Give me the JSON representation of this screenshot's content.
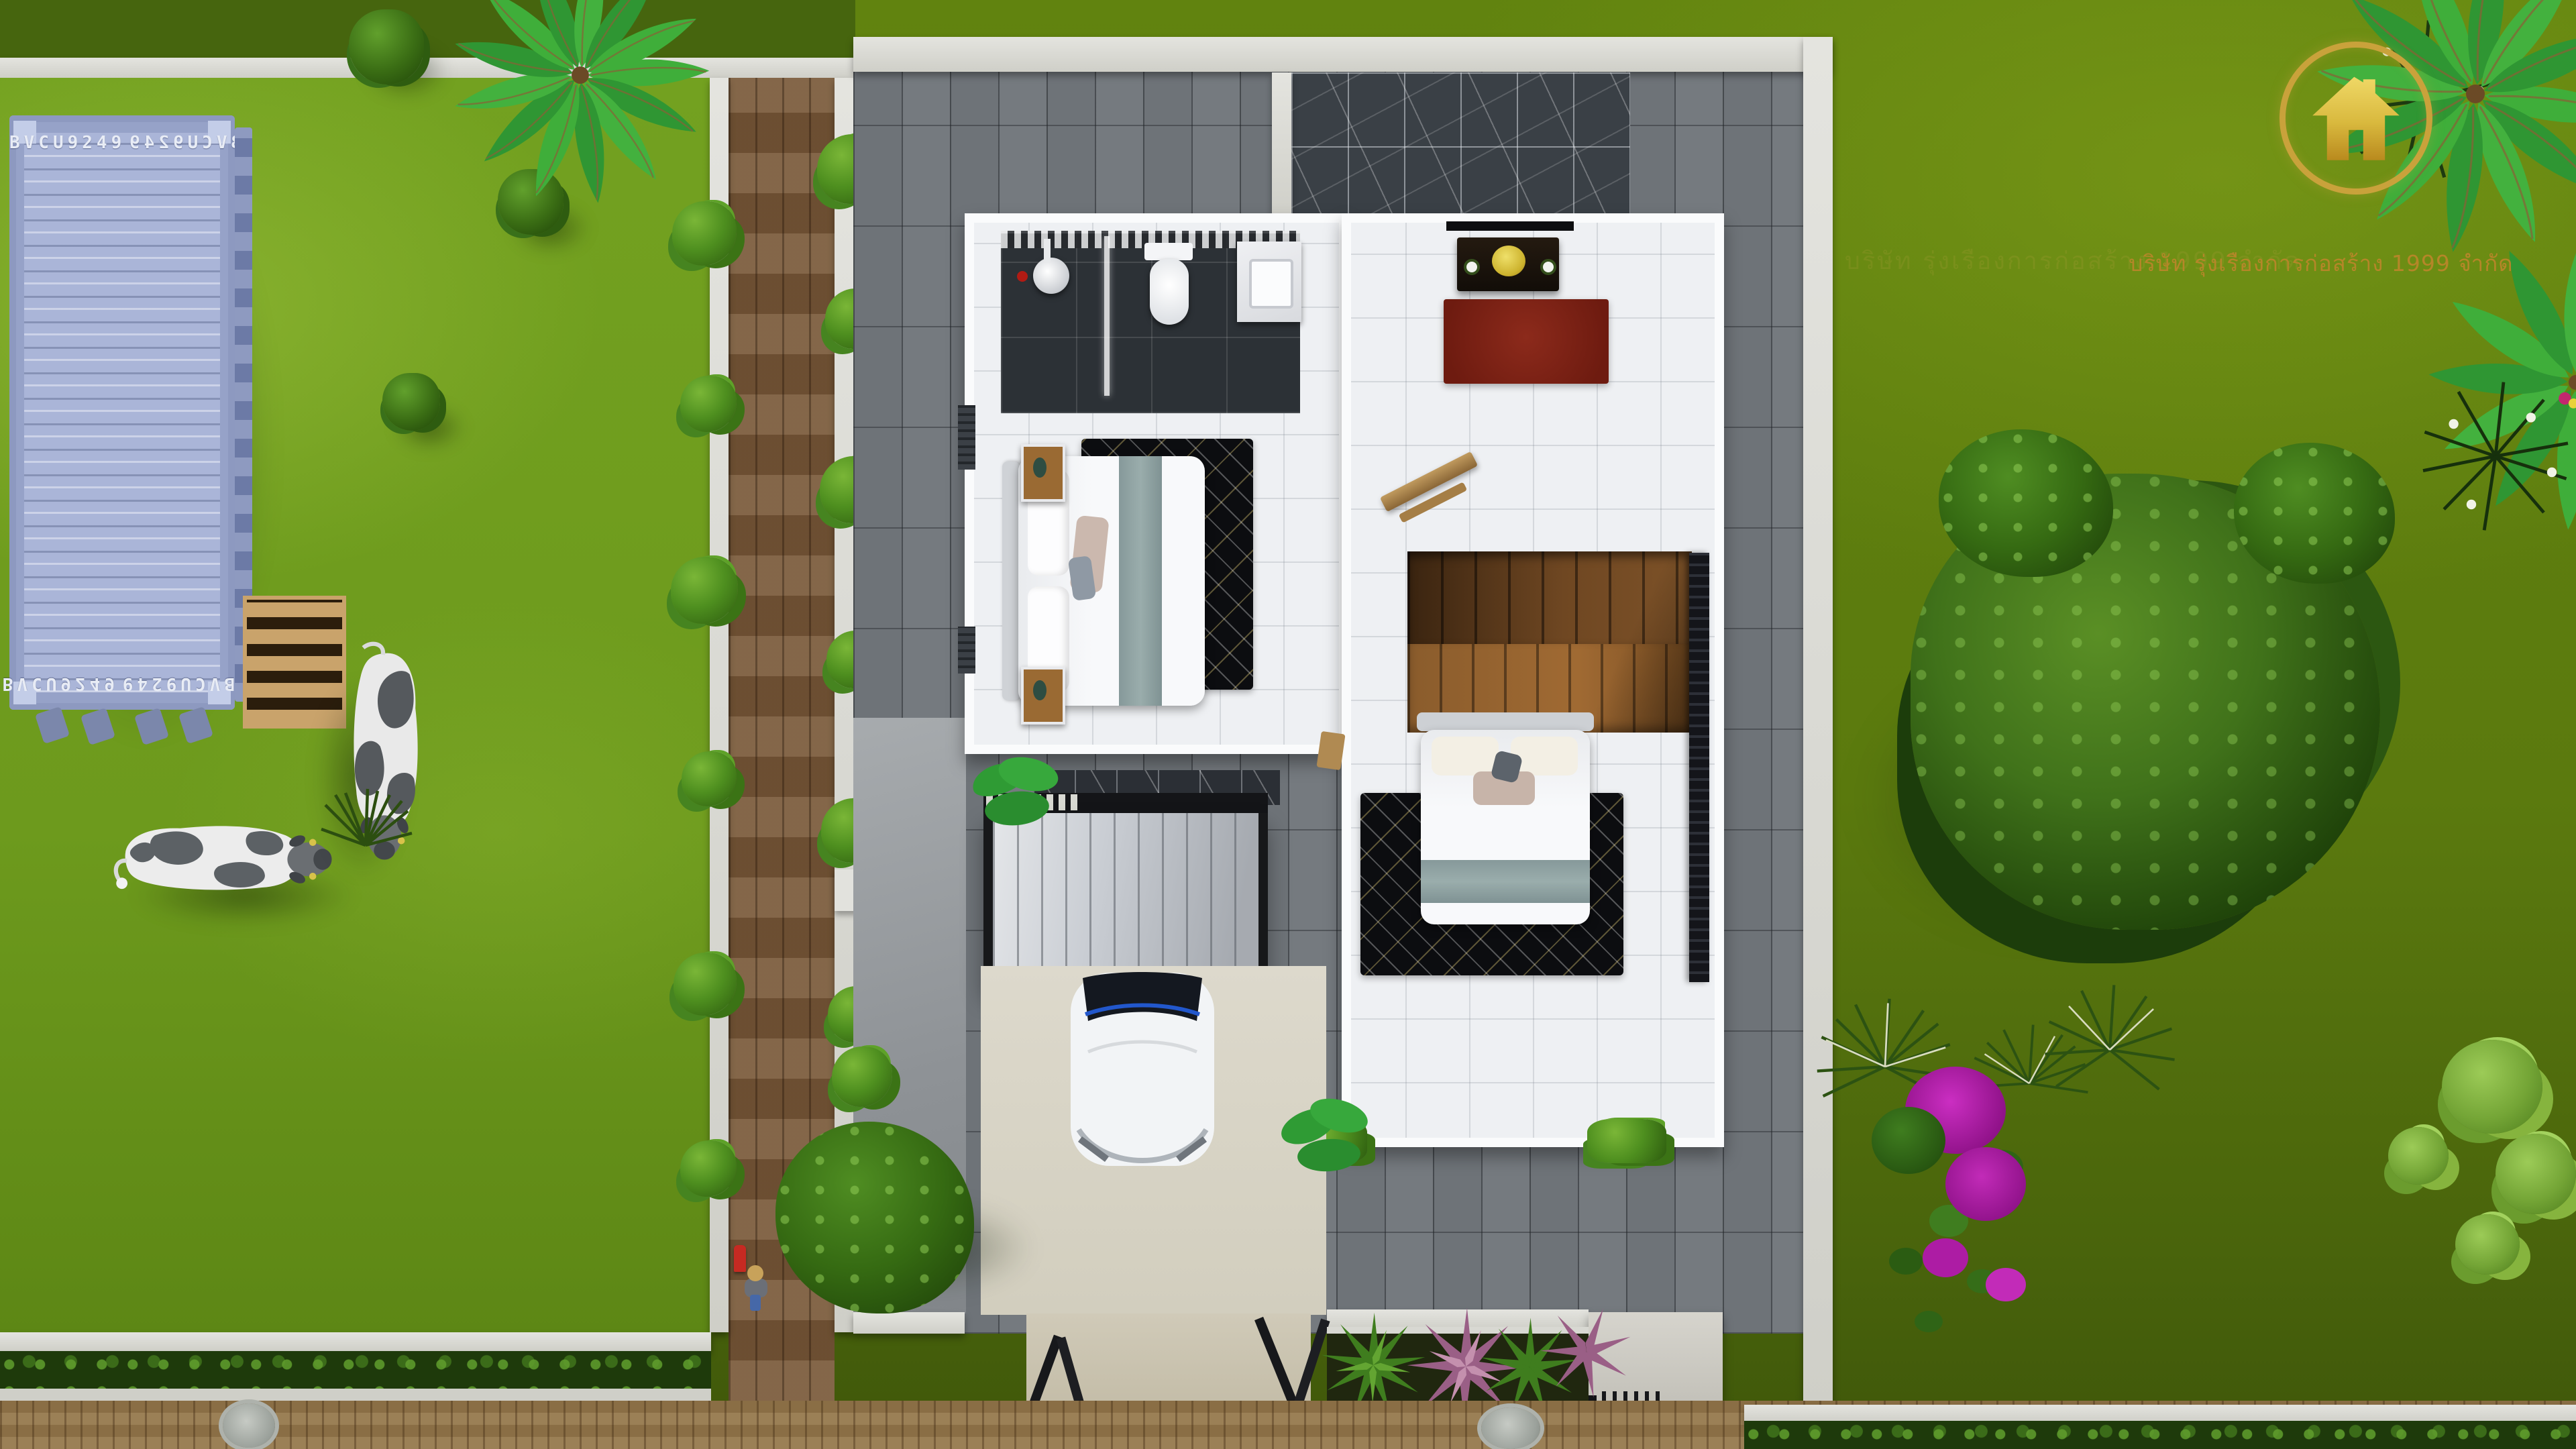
{
  "scene": {
    "description": "Aerial 3D architectural render: second-floor cutaway plan of a modern two-storey white house with carport, gardens, shipping container yard with cows, brick road and company watermark logo",
    "branding": {
      "company_text": "บริษัท รุ่งเรืองการก่อสร้าง 1999 จำกัด",
      "logo_shape": "gold house glyph inside gold ring",
      "gold_color": "#c9a23b",
      "text_color": "#b9862a"
    },
    "container": {
      "code": "BVCU9249",
      "body_color": "#aab5d8"
    },
    "palette": {
      "lawn_left": "#6f9e1d",
      "lawn_right": "#5e7e10",
      "pavers_gray": "#6e7378",
      "brick_path_brown": "#7b5b3b",
      "road_brown": "#96794d",
      "marble_dark": "#3a4046",
      "stair_wood": "#6f4722",
      "red_rug": "#7c2015",
      "carport_roof": "#c9cdd3",
      "bougainvillea": "#b01fa8"
    },
    "objects": [
      "shipping-container",
      "wooden-pallet",
      "cow-grazing",
      "cow-standing",
      "gold-house-logo",
      "bathroom",
      "bedroom-1",
      "family-room",
      "staircase",
      "bedroom-2",
      "carport",
      "white-car",
      "driveway-tree",
      "big-garden-tree",
      "bougainvillea-bush",
      "banana-palm",
      "spiky-plants",
      "hedge-row",
      "manhole-cover",
      "walkway-bushes",
      "person-walking",
      "fire-hydrant",
      "gate-leaves"
    ]
  }
}
